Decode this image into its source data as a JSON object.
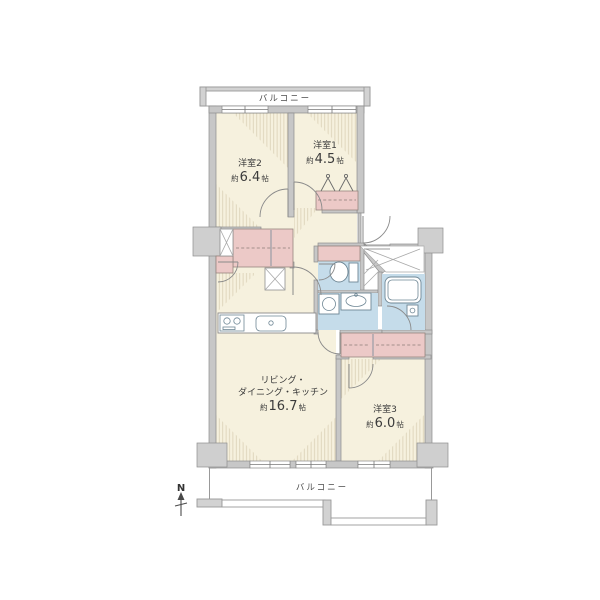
{
  "plan": {
    "balcony_top": "バルコニー",
    "balcony_bottom": "バルコニー",
    "north": "N",
    "room1": {
      "name": "洋室1",
      "prefix": "約",
      "value": "4.5",
      "unit": "帖"
    },
    "room2": {
      "name": "洋室2",
      "prefix": "約",
      "value": "6.4",
      "unit": "帖"
    },
    "room3": {
      "name": "洋室3",
      "prefix": "約",
      "value": "6.0",
      "unit": "帖"
    },
    "ldk": {
      "line1": "リビング・",
      "line2": "ダイニング・キッチン",
      "prefix": "約",
      "value": "16.7",
      "unit": "帖"
    }
  },
  "colors": {
    "room_floor": "#f6f1de",
    "closet": "#ecc9c7",
    "wet_area": "#c5dcea",
    "wall": "#c7c7c7",
    "text": "#3b3b3b",
    "balcony": "#ffffff"
  }
}
